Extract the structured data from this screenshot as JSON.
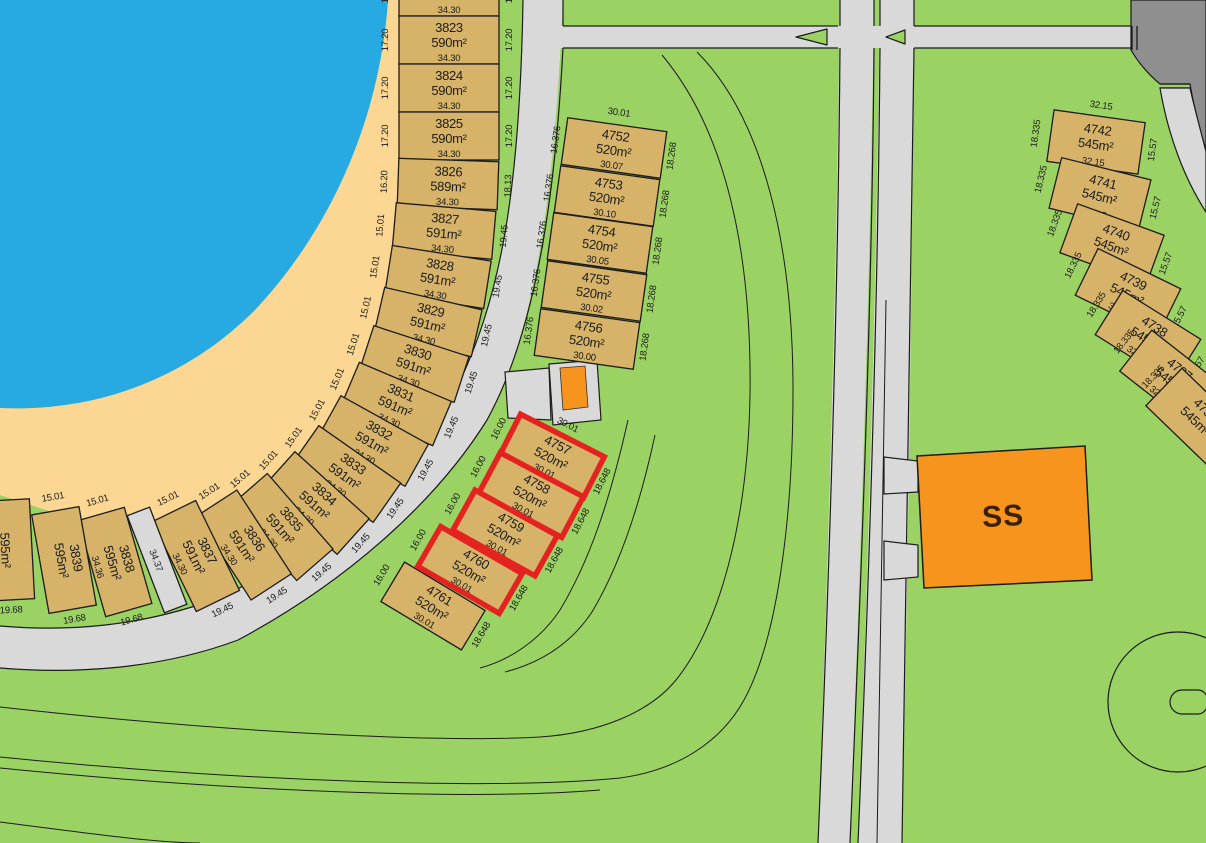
{
  "map": {
    "title": "subdivision-plan",
    "colors": {
      "background_green": "#9ad264",
      "water_blue": "#27a9e1",
      "beach_sand": "#fbd793",
      "road_gray": "#d9d9d9",
      "road_dark_gray": "#8f8f8f",
      "lot_tan": "#d6b369",
      "highlight_red": "#e42320",
      "building_orange": "#f7941e",
      "line_black": "#1c1c1c"
    },
    "beach_lots": {
      "items": [
        {
          "id": "",
          "area": "590m²",
          "dim": "34.30",
          "beach": "17.20",
          "road": "17.20"
        },
        {
          "id": "3823",
          "area": "590m²",
          "dim": "34.30",
          "beach": "17.20",
          "road": "17.20"
        },
        {
          "id": "3824",
          "area": "590m²",
          "dim": "34.30",
          "beach": "17.20",
          "road": "17.20"
        },
        {
          "id": "3825",
          "area": "590m²",
          "dim": "34.30",
          "beach": "17.20",
          "road": "17.20"
        },
        {
          "id": "3826",
          "area": "589m²",
          "dim": "34.30",
          "beach": "16.20",
          "road": "18.13"
        },
        {
          "id": "3827",
          "area": "591m²",
          "dim": "34.30",
          "beach": "15.01",
          "road": "19.45"
        },
        {
          "id": "3828",
          "area": "591m²",
          "dim": "34.30",
          "beach": "15.01",
          "road": "19.45"
        },
        {
          "id": "3829",
          "area": "591m²",
          "dim": "34.30",
          "beach": "15.01",
          "road": "19.45"
        },
        {
          "id": "3830",
          "area": "591m²",
          "dim": "34.30",
          "beach": "15.01",
          "road": "19.45"
        },
        {
          "id": "3831",
          "area": "591m²",
          "dim": "34.30",
          "beach": "15.01",
          "road": "19.45"
        },
        {
          "id": "3832",
          "area": "591m²",
          "dim": "34.30",
          "beach": "15.01",
          "road": "19.45"
        },
        {
          "id": "3833",
          "area": "591m²",
          "dim": "34.30",
          "beach": "15.01",
          "road": "19.45"
        },
        {
          "id": "3834",
          "area": "591m²",
          "dim": "34.30",
          "beach": "15.01",
          "road": "19.45"
        },
        {
          "id": "3835",
          "area": "591m²",
          "dim": "34.30",
          "beach": "15.01",
          "road": "19.45"
        },
        {
          "id": "3836",
          "area": "591m²",
          "dim": "34.30",
          "beach": "15.01",
          "road": "19.45"
        },
        {
          "id": "3837",
          "area": "591m²",
          "dim": "34.30",
          "beach": "15.01",
          "road": "19.45"
        },
        {
          "id": "",
          "area": "",
          "dim": "34.37",
          "beach": "",
          "road": "",
          "path": true
        },
        {
          "id": "3838",
          "area": "595m²",
          "dim": "34.36",
          "beach": "15.01",
          "road": "19.68"
        },
        {
          "id": "3839",
          "area": "595m²",
          "dim": "",
          "beach": "15.01",
          "road": "19.68"
        },
        {
          "id": "",
          "area": "595m²",
          "dim": "",
          "beach": "",
          "road": "19.68"
        }
      ]
    },
    "mid_lots": {
      "top_dim": "30.01",
      "left_dims": [
        "16.376",
        "16.376",
        "16.376",
        "16.376",
        "16.376"
      ],
      "right_dims": [
        "18.268",
        "18.268",
        "18.268",
        "18.268",
        "18.268"
      ],
      "items": [
        {
          "id": "4752",
          "area": "520m²",
          "dim": "30.07"
        },
        {
          "id": "4753",
          "area": "520m²",
          "dim": "30.10"
        },
        {
          "id": "4754",
          "area": "520m²",
          "dim": "30.05"
        },
        {
          "id": "4755",
          "area": "520m²",
          "dim": "30.02"
        },
        {
          "id": "4756",
          "area": "520m²",
          "dim": "30.00"
        }
      ]
    },
    "red_lots": {
      "top_dim": "30.01",
      "left_dims": [
        "16.00",
        "16.00",
        "16.00",
        "16.00",
        "16.00"
      ],
      "right_dims": [
        "18.648",
        "18.648",
        "18.648",
        "18.648",
        "18.648"
      ],
      "items": [
        {
          "id": "4757",
          "area": "520m²",
          "dim": "30.01",
          "highlight": true
        },
        {
          "id": "4758",
          "area": "520m²",
          "dim": "30.01",
          "highlight": true
        },
        {
          "id": "4759",
          "area": "520m²",
          "dim": "30.01",
          "highlight": true
        },
        {
          "id": "4760",
          "area": "520m²",
          "dim": "30.01",
          "highlight": true
        },
        {
          "id": "4761",
          "area": "520m²",
          "dim": "30.01",
          "highlight": false
        }
      ]
    },
    "east_lots": {
      "top_dim": "32.15",
      "left_dims": [
        "18.335",
        "18.335",
        "18.335",
        "18.335",
        "18.335",
        "18.335",
        "18.335"
      ],
      "right_dims": [
        "15.57",
        "15.57",
        "15.57",
        "15.57",
        "15.57",
        "15.57"
      ],
      "items": [
        {
          "id": "4742",
          "area": "545m²",
          "dim": "32.15"
        },
        {
          "id": "4741",
          "area": "545m²",
          "dim": "32.15"
        },
        {
          "id": "4740",
          "area": "545m²",
          "dim": "32.15"
        },
        {
          "id": "4739",
          "area": "545m²",
          "dim": "32.15"
        },
        {
          "id": "4738",
          "area": "545m²",
          "dim": "32.15"
        },
        {
          "id": "4737",
          "area": "545m²",
          "dim": "32.15"
        },
        {
          "id": "4736",
          "area": "545m²",
          "dim": ""
        }
      ]
    },
    "ss_label": "SS"
  }
}
